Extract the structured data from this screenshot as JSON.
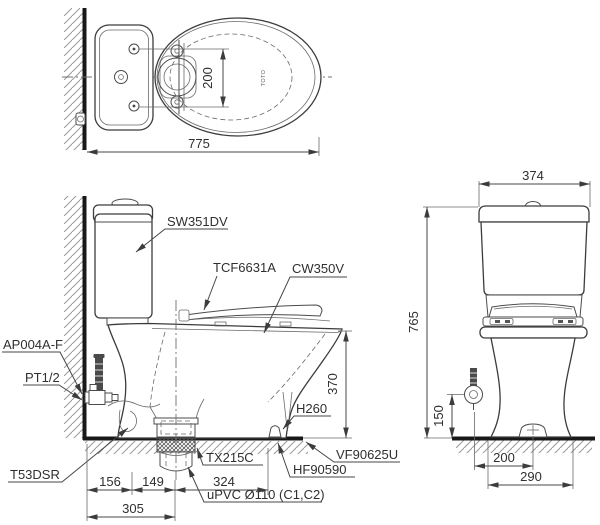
{
  "drawing": {
    "background_color": "#ffffff",
    "line_color": "#4b4b4b",
    "heavy_line_color": "#181818",
    "text_color": "#2f2f2f",
    "top_view": {
      "brand_mark": "TOTO",
      "dim_hinge_spacing": "200",
      "dim_overall_depth": "775"
    },
    "side_view": {
      "labels": {
        "tank_model": "SW351DV",
        "seat_model": "TCF6631A",
        "bowl_model": "CW350V",
        "angle_valve": "AP004A-F",
        "thread_size": "PT1/2",
        "supply_valve": "T53DSR",
        "flange": "TX215C",
        "bolt_cap": "H260",
        "floor_fixing": "HF90590",
        "seal": "VF90625U",
        "drain_pipe": "uPVC Ø110 (C1,C2)"
      },
      "dims": {
        "rim_height": "370",
        "seg_wall_to_trap": "156",
        "seg_trap_to_outlet": "149",
        "seg_outlet_to_bolt": "324",
        "rough_in": "305"
      }
    },
    "front_view": {
      "dims": {
        "tank_width": "374",
        "overall_height": "765",
        "supply_height": "150",
        "outlet_offset": "200",
        "base_width": "290"
      }
    }
  }
}
